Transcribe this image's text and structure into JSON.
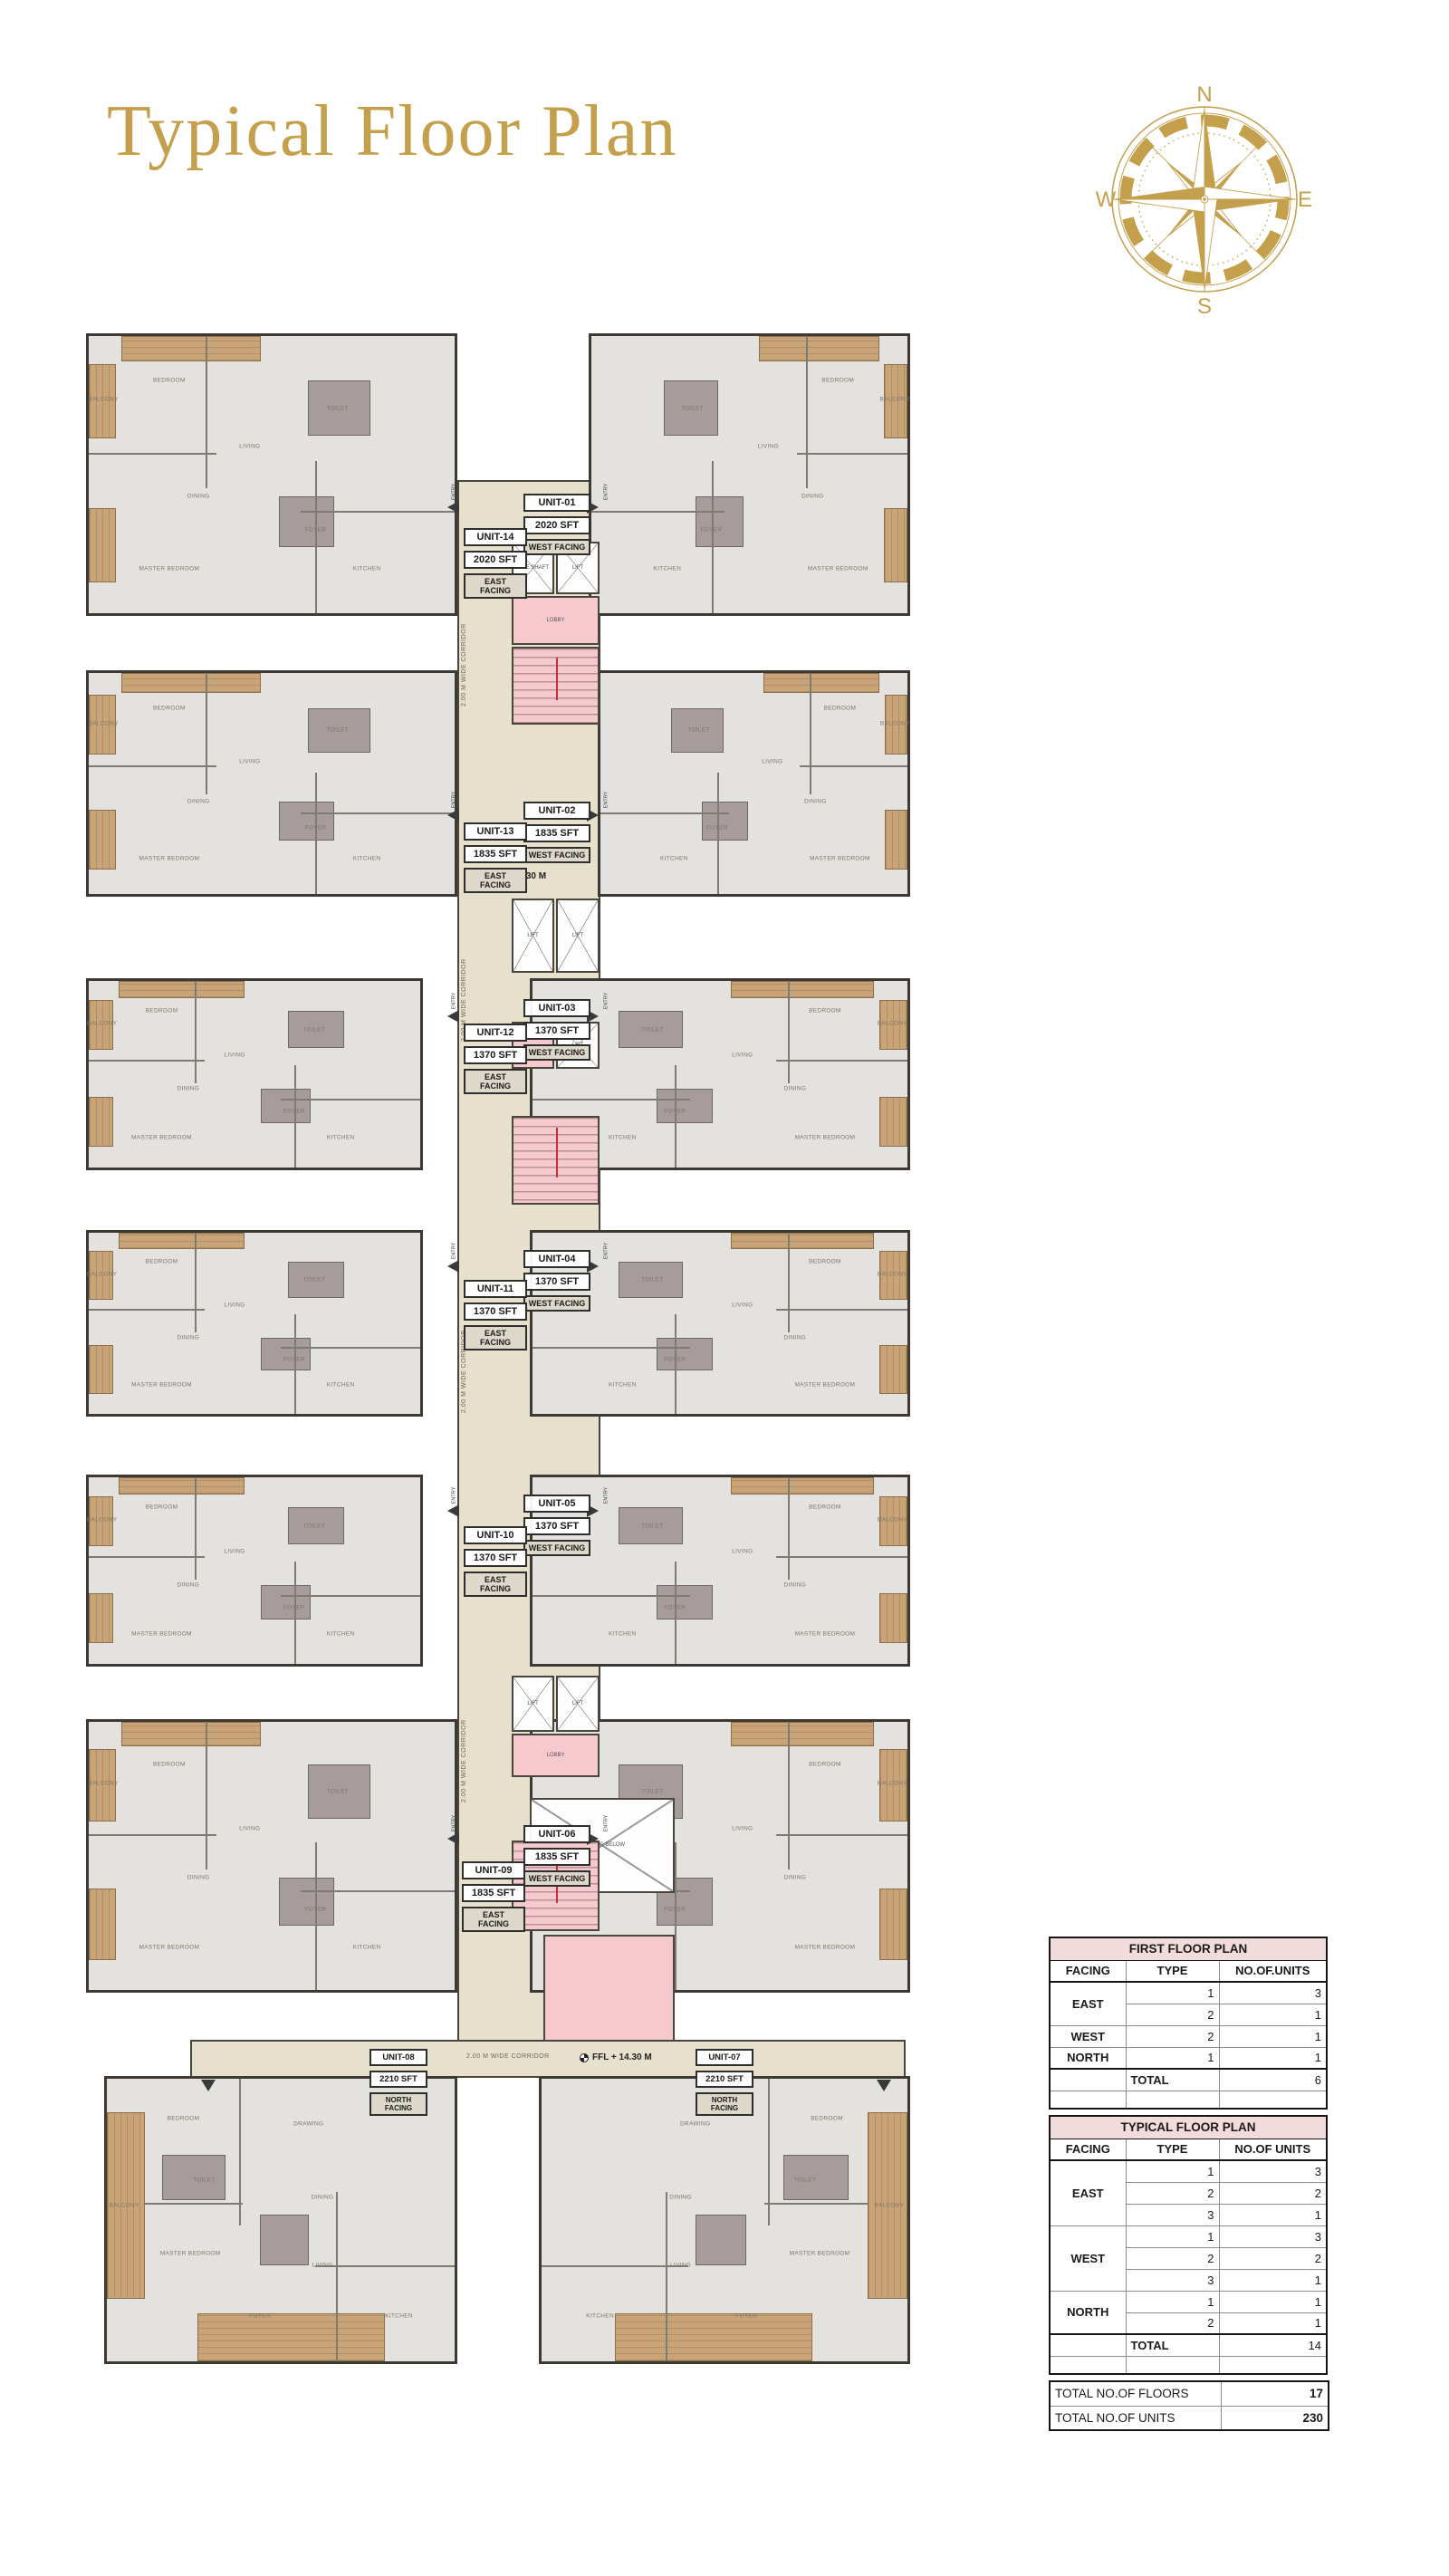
{
  "page": {
    "title": "Typical Floor Plan"
  },
  "compass": {
    "n": "N",
    "e": "E",
    "s": "S",
    "w": "W"
  },
  "colors": {
    "accent_gold": "#C4A04C",
    "table_header_pink": "#F2DBDB",
    "stair_pink": "#F6C9CE",
    "corridor_beige": "#E7E0CD"
  },
  "plan": {
    "corridor_label": "2.00 M WIDE CORRIDOR",
    "ffl_upper": "FFL 14.30 M",
    "ffl_lower": "FFL + 14.30 M",
    "entry_label": "ENTRY",
    "core_labels": {
      "fire_shaft": "FIRE SHAFT",
      "lift": "LIFT",
      "lobby": "LOBBY",
      "open_to_below": "OPEN TO BELOW"
    },
    "room_names": {
      "bedroom": "BEDROOM",
      "m_bedroom": "MASTER BEDROOM",
      "living": "LIVING",
      "dining": "DINING",
      "kitchen": "KITCHEN",
      "toilet": "TOILET",
      "balcony": "BALCONY",
      "drawing": "DRAWING",
      "foyer": "FOYER"
    },
    "units": [
      {
        "id": "UNIT-01",
        "area": "2020 SFT",
        "facing": "WEST FACING"
      },
      {
        "id": "UNIT-02",
        "area": "1835 SFT",
        "facing": "WEST FACING"
      },
      {
        "id": "UNIT-03",
        "area": "1370 SFT",
        "facing": "WEST FACING"
      },
      {
        "id": "UNIT-04",
        "area": "1370 SFT",
        "facing": "WEST FACING"
      },
      {
        "id": "UNIT-05",
        "area": "1370 SFT",
        "facing": "WEST FACING"
      },
      {
        "id": "UNIT-06",
        "area": "1835 SFT",
        "facing": "WEST FACING"
      },
      {
        "id": "UNIT-07",
        "area": "2210 SFT",
        "facing": "NORTH FACING"
      },
      {
        "id": "UNIT-08",
        "area": "2210 SFT",
        "facing": "NORTH FACING"
      },
      {
        "id": "UNIT-09",
        "area": "1835 SFT",
        "facing": "EAST FACING"
      },
      {
        "id": "UNIT-10",
        "area": "1370 SFT",
        "facing": "EAST FACING"
      },
      {
        "id": "UNIT-11",
        "area": "1370 SFT",
        "facing": "EAST FACING"
      },
      {
        "id": "UNIT-12",
        "area": "1370 SFT",
        "facing": "EAST FACING"
      },
      {
        "id": "UNIT-13",
        "area": "1835 SFT",
        "facing": "EAST FACING"
      },
      {
        "id": "UNIT-14",
        "area": "2020 SFT",
        "facing": "EAST FACING"
      }
    ]
  },
  "tables": {
    "first_floor": {
      "title": "FIRST FLOOR PLAN",
      "headers": [
        "FACING",
        "TYPE",
        "NO.OF.UNITS"
      ],
      "groups": [
        {
          "facing": "EAST",
          "rows": [
            {
              "type": "1",
              "units": "3"
            },
            {
              "type": "2",
              "units": "1"
            }
          ]
        },
        {
          "facing": "WEST",
          "rows": [
            {
              "type": "2",
              "units": "1"
            }
          ]
        },
        {
          "facing": "NORTH",
          "rows": [
            {
              "type": "1",
              "units": "1"
            }
          ]
        }
      ],
      "total_label": "TOTAL",
      "total": "6"
    },
    "typical_floor": {
      "title": "TYPICAL FLOOR PLAN",
      "headers": [
        "FACING",
        "TYPE",
        "NO.OF UNITS"
      ],
      "groups": [
        {
          "facing": "EAST",
          "rows": [
            {
              "type": "1",
              "units": "3"
            },
            {
              "type": "2",
              "units": "2"
            },
            {
              "type": "3",
              "units": "1"
            }
          ]
        },
        {
          "facing": "WEST",
          "rows": [
            {
              "type": "1",
              "units": "3"
            },
            {
              "type": "2",
              "units": "2"
            },
            {
              "type": "3",
              "units": "1"
            }
          ]
        },
        {
          "facing": "NORTH",
          "rows": [
            {
              "type": "1",
              "units": "1"
            },
            {
              "type": "2",
              "units": "1"
            }
          ]
        }
      ],
      "total_label": "TOTAL",
      "total": "14"
    },
    "summary": [
      {
        "label": "TOTAL NO.OF FLOORS",
        "value": "17"
      },
      {
        "label": "TOTAL NO.OF UNITS",
        "value": "230"
      }
    ]
  }
}
